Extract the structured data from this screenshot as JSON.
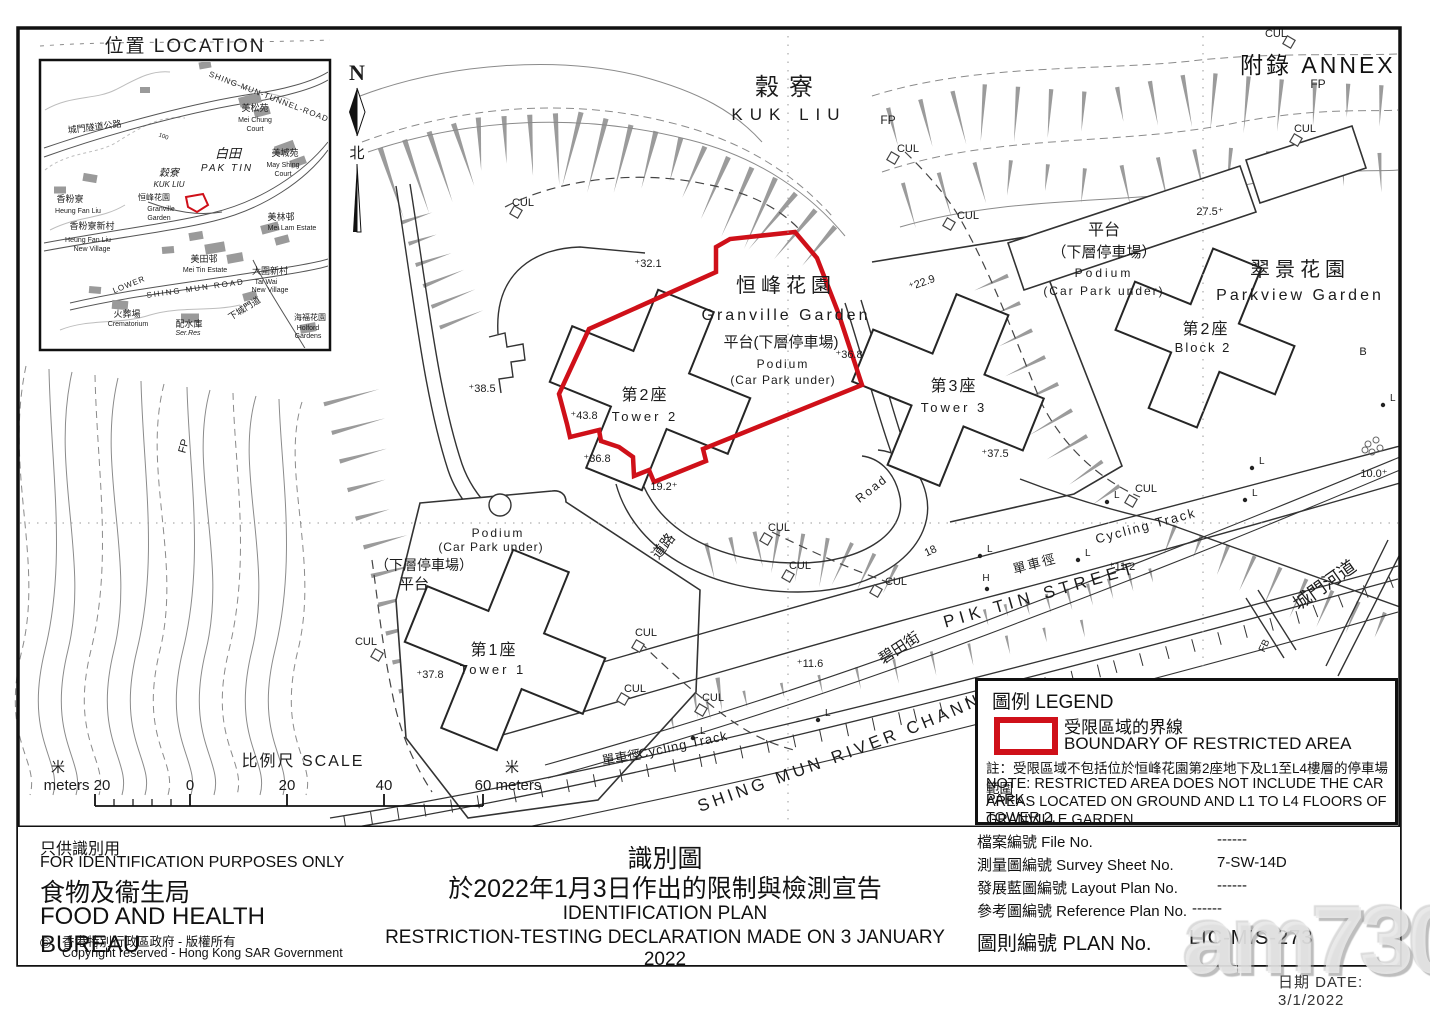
{
  "page": {
    "annex": "附錄 ANNEX",
    "watermark": "am730"
  },
  "colors": {
    "boundary_red": "#cf1019",
    "line_dark": "#2a2a2a",
    "line_gray": "#888888"
  },
  "compass": {
    "n": "N",
    "north": "北"
  },
  "inset": {
    "title": "位置 LOCATION",
    "labels": [
      {
        "t": "SHING-MUN-TUNNEL-ROAD",
        "x": 268,
        "y": 99,
        "s": 8,
        "r": 21,
        "sp": 1
      },
      {
        "t": "城門隧道公路",
        "x": 95,
        "y": 130,
        "s": 9,
        "r": -7
      },
      {
        "t": "100",
        "x": 163,
        "y": 138,
        "s": 6,
        "r": 20
      },
      {
        "t": "美松苑",
        "x": 255,
        "y": 111,
        "s": 9
      },
      {
        "t": "Mei Chung",
        "x": 255,
        "y": 122,
        "s": 7
      },
      {
        "t": "Court",
        "x": 255,
        "y": 131,
        "s": 7
      },
      {
        "t": "白田",
        "x": 228,
        "y": 158,
        "s": 13,
        "i": 1
      },
      {
        "t": "PAK TIN",
        "x": 227,
        "y": 171,
        "s": 10,
        "i": 1,
        "sp": 2
      },
      {
        "t": "美城苑",
        "x": 285,
        "y": 156,
        "s": 9
      },
      {
        "t": "May Shing",
        "x": 283,
        "y": 167,
        "s": 7
      },
      {
        "t": "Court",
        "x": 283,
        "y": 176,
        "s": 7
      },
      {
        "t": "穀寮",
        "x": 169,
        "y": 176,
        "s": 10,
        "i": 1
      },
      {
        "t": "KUK LIU",
        "x": 169,
        "y": 187,
        "s": 8,
        "i": 1
      },
      {
        "t": "恒峰花園",
        "x": 154,
        "y": 200,
        "s": 8
      },
      {
        "t": "Granville",
        "x": 161,
        "y": 211,
        "s": 7
      },
      {
        "t": "Garden",
        "x": 159,
        "y": 220,
        "s": 7
      },
      {
        "t": "香粉寮",
        "x": 70,
        "y": 202,
        "s": 9
      },
      {
        "t": "Heung Fan Liu",
        "x": 78,
        "y": 213,
        "s": 7
      },
      {
        "t": "香粉寮新村",
        "x": 92,
        "y": 229,
        "s": 9
      },
      {
        "t": "Heung Fan Liu",
        "x": 88,
        "y": 242,
        "s": 7
      },
      {
        "t": "New Village",
        "x": 92,
        "y": 251,
        "s": 7
      },
      {
        "t": "美林邨",
        "x": 281,
        "y": 220,
        "s": 9
      },
      {
        "t": "Mei Lam Estate",
        "x": 292,
        "y": 230,
        "s": 7
      },
      {
        "t": "美田邨",
        "x": 204,
        "y": 262,
        "s": 9
      },
      {
        "t": "Mei Tin Estate",
        "x": 205,
        "y": 272,
        "s": 7
      },
      {
        "t": "大圍新村",
        "x": 270,
        "y": 274,
        "s": 9
      },
      {
        "t": "Tai Wai",
        "x": 266,
        "y": 284,
        "s": 7
      },
      {
        "t": "New Village",
        "x": 270,
        "y": 292,
        "s": 7
      },
      {
        "t": "LOWER",
        "x": 130,
        "y": 287,
        "s": 8,
        "r": -22,
        "sp": 1
      },
      {
        "t": "SHING MUN ROAD",
        "x": 196,
        "y": 291,
        "s": 8,
        "r": -8,
        "sp": 2
      },
      {
        "t": "火葬場",
        "x": 127,
        "y": 317,
        "s": 9
      },
      {
        "t": "Crematorium",
        "x": 128,
        "y": 326,
        "s": 7
      },
      {
        "t": "配水庫",
        "x": 189,
        "y": 327,
        "s": 9
      },
      {
        "t": "Ser.Res",
        "x": 188,
        "y": 335,
        "s": 7,
        "i": 1
      },
      {
        "t": "下城門道",
        "x": 246,
        "y": 311,
        "s": 9,
        "r": -32
      },
      {
        "t": "海福花園",
        "x": 310,
        "y": 320,
        "s": 8
      },
      {
        "t": "Holford",
        "x": 308,
        "y": 330,
        "s": 7
      },
      {
        "t": "Gardens",
        "x": 308,
        "y": 338,
        "s": 7
      }
    ]
  },
  "map": {
    "river": "SHING MUN RIVER CHANNEL",
    "lamp": "L",
    "labels": [
      {
        "t": "穀寮",
        "x": 789,
        "y": 95,
        "s": 24,
        "sp": 10
      },
      {
        "t": "KUK LIU",
        "x": 789,
        "y": 120,
        "s": 17,
        "sp": 7
      },
      {
        "t": "FP",
        "x": 888,
        "y": 124,
        "s": 12
      },
      {
        "t": "CUL",
        "x": 908,
        "y": 152,
        "s": 11
      },
      {
        "t": "CUL",
        "x": 523,
        "y": 206,
        "s": 11
      },
      {
        "t": "CUL",
        "x": 968,
        "y": 219,
        "s": 11
      },
      {
        "t": "CUL",
        "x": 1276,
        "y": 37,
        "s": 11
      },
      {
        "t": "FP",
        "x": 1318,
        "y": 88,
        "s": 12
      },
      {
        "t": "CUL",
        "x": 1305,
        "y": 132,
        "s": 11
      },
      {
        "t": "平台",
        "x": 1104,
        "y": 235,
        "s": 16
      },
      {
        "t": "（下層停車場）",
        "x": 1104,
        "y": 257,
        "s": 15
      },
      {
        "t": "Podium",
        "x": 1104,
        "y": 277,
        "s": 12,
        "sp": 3
      },
      {
        "t": "(Car Park under)",
        "x": 1104,
        "y": 295,
        "s": 12,
        "sp": 2
      },
      {
        "t": "27.5⁺",
        "x": 1210,
        "y": 215,
        "s": 11
      },
      {
        "t": "翠景花園",
        "x": 1300,
        "y": 276,
        "s": 20,
        "sp": 5
      },
      {
        "t": "Parkview Garden",
        "x": 1300,
        "y": 300,
        "s": 16,
        "sp": 3
      },
      {
        "t": "第2座",
        "x": 1206,
        "y": 334,
        "s": 16,
        "sp": 2
      },
      {
        "t": "Block 2",
        "x": 1203,
        "y": 352,
        "s": 13,
        "sp": 2
      },
      {
        "t": "⁺22.9",
        "x": 923,
        "y": 286,
        "s": 11,
        "r": -20
      },
      {
        "t": "恒峰花園",
        "x": 786,
        "y": 292,
        "s": 20,
        "sp": 5
      },
      {
        "t": "Granville Garden",
        "x": 786,
        "y": 320,
        "s": 16,
        "sp": 3
      },
      {
        "t": "平台(下層停車場)",
        "x": 781,
        "y": 347,
        "s": 15
      },
      {
        "t": "Podium",
        "x": 783,
        "y": 368,
        "s": 12,
        "sp": 2
      },
      {
        "t": "(Car Park under)",
        "x": 783,
        "y": 384,
        "s": 12,
        "sp": 1
      },
      {
        "t": "⁺36.8",
        "x": 849,
        "y": 358,
        "s": 11
      },
      {
        "t": "⁺32.1",
        "x": 648,
        "y": 267,
        "s": 11
      },
      {
        "t": "⁺38.5",
        "x": 482,
        "y": 392,
        "s": 11
      },
      {
        "t": "第2座",
        "x": 645,
        "y": 400,
        "s": 16,
        "sp": 2
      },
      {
        "t": "Tower 2",
        "x": 645,
        "y": 421,
        "s": 13,
        "sp": 3
      },
      {
        "t": "⁺43.8",
        "x": 584,
        "y": 419,
        "s": 11
      },
      {
        "t": "⁺36.8",
        "x": 597,
        "y": 462,
        "s": 11
      },
      {
        "t": "19.2⁺",
        "x": 664,
        "y": 490,
        "s": 11
      },
      {
        "t": "第3座",
        "x": 954,
        "y": 391,
        "s": 16,
        "sp": 2
      },
      {
        "t": "Tower 3",
        "x": 954,
        "y": 412,
        "s": 13,
        "sp": 3
      },
      {
        "t": "⁺37.5",
        "x": 995,
        "y": 457,
        "s": 11
      },
      {
        "t": "Road",
        "x": 874,
        "y": 492,
        "s": 12,
        "r": -38,
        "sp": 2
      },
      {
        "t": "道路",
        "x": 667,
        "y": 549,
        "s": 14,
        "r": -52
      },
      {
        "t": "CUL",
        "x": 779,
        "y": 531,
        "s": 11
      },
      {
        "t": "CUL",
        "x": 800,
        "y": 569,
        "s": 11
      },
      {
        "t": "CUL",
        "x": 896,
        "y": 585,
        "s": 11
      },
      {
        "t": "18",
        "x": 932,
        "y": 554,
        "s": 11,
        "r": -25
      },
      {
        "t": "CUL",
        "x": 1146,
        "y": 492,
        "s": 11
      },
      {
        "t": "H",
        "x": 986,
        "y": 581,
        "s": 10
      },
      {
        "t": "單車徑",
        "x": 1036,
        "y": 568,
        "s": 13,
        "r": -15,
        "sp": 2
      },
      {
        "t": "Cycling Track",
        "x": 1147,
        "y": 530,
        "s": 13,
        "r": -15,
        "sp": 2
      },
      {
        "t": "PIK TIN STREET",
        "x": 1042,
        "y": 600,
        "s": 17,
        "r": -16,
        "sp": 5
      },
      {
        "t": "⁺11.2",
        "x": 1122,
        "y": 570,
        "s": 11
      },
      {
        "t": "碧田街",
        "x": 902,
        "y": 652,
        "s": 15,
        "r": -33
      },
      {
        "t": "⁺11.6",
        "x": 810,
        "y": 667,
        "s": 11
      },
      {
        "t": "城門河道",
        "x": 1328,
        "y": 590,
        "s": 18,
        "r": -35
      },
      {
        "t": "單車徑",
        "x": 622,
        "y": 762,
        "s": 13,
        "r": -10
      },
      {
        "t": "Cycling Track",
        "x": 684,
        "y": 749,
        "s": 13,
        "r": -12,
        "sp": 1
      },
      {
        "t": "FP",
        "x": 187,
        "y": 447,
        "s": 11,
        "r": -75
      },
      {
        "t": "CUL",
        "x": 366,
        "y": 645,
        "s": 11
      },
      {
        "t": "Podium",
        "x": 498,
        "y": 537,
        "s": 12,
        "sp": 2
      },
      {
        "t": "(Car Park under)",
        "x": 491,
        "y": 551,
        "s": 12,
        "sp": 1
      },
      {
        "t": "（下層停車場）",
        "x": 424,
        "y": 570,
        "s": 14
      },
      {
        "t": "平台",
        "x": 414,
        "y": 589,
        "s": 15
      },
      {
        "t": "第1座",
        "x": 494,
        "y": 655,
        "s": 16,
        "sp": 2
      },
      {
        "t": "Tower 1",
        "x": 493,
        "y": 674,
        "s": 13,
        "sp": 3
      },
      {
        "t": "⁺37.8",
        "x": 430,
        "y": 678,
        "s": 11
      },
      {
        "t": "CUL",
        "x": 646,
        "y": 636,
        "s": 11
      },
      {
        "t": "CUL",
        "x": 635,
        "y": 692,
        "s": 11
      },
      {
        "t": "CUL",
        "x": 713,
        "y": 701,
        "s": 11
      },
      {
        "t": "10.0⁺",
        "x": 1374,
        "y": 477,
        "s": 11
      },
      {
        "t": "B",
        "x": 1363,
        "y": 355,
        "s": 11
      },
      {
        "t": "FB",
        "x": 1267,
        "y": 647,
        "s": 10,
        "r": -65
      }
    ]
  },
  "legend": {
    "title": "圖例 LEGEND",
    "item_zh": "受限區域的界線",
    "item_en": "BOUNDARY OF RESTRICTED AREA",
    "note_line1": "註：受限區域不包括位於恒峰花園第2座地下及L1至L4樓層的停車場範圍",
    "note_line2": "NOTE: RESTRICTED AREA DOES NOT INCLUDE THE CAR PARK",
    "note_line3": "AREAS LOCATED ON GROUND AND L1 TO L4 FLOORS OF TOWER 2,",
    "note_line4": "GRANVILLE GARDEN"
  },
  "scale": {
    "title": "比例尺 SCALE",
    "m_zh_left": "米",
    "m_zh_right": "米",
    "v_m20": "meters 20",
    "v0": "0",
    "v20": "20",
    "v40": "40",
    "v60": "60 meters"
  },
  "footer": {
    "left": {
      "zh1": "只供識別用",
      "en1": "FOR IDENTIFICATION PURPOSES ONLY",
      "zh2": "食物及衞生局",
      "en2": "FOOD AND HEALTH BUREAU",
      "copyright_symbol": "©",
      "copy_zh": "香港特別行政區政府 - 版權所有",
      "copy_en": "Copyright reserved - Hong Kong SAR Government"
    },
    "center": {
      "zh1": "識別圖",
      "zh2": "於2022年1月3日作出的限制與檢測宣告",
      "en1": "IDENTIFICATION PLAN",
      "en2": "RESTRICTION-TESTING DECLARATION MADE ON 3 JANUARY 2022"
    },
    "table": [
      {
        "label": "檔案編號 File No.",
        "value": "------"
      },
      {
        "label": "測量圖編號 Survey Sheet No.",
        "value": "7-SW-14D"
      },
      {
        "label": "發展藍圖編號 Layout Plan No.",
        "value": "------"
      },
      {
        "label": "參考圖編號 Reference Plan No.",
        "value": "------"
      }
    ],
    "plan_label": "圖則編號 PLAN No.",
    "plan_value": "LIC-MIS-273",
    "date": "日期 DATE: 3/1/2022"
  }
}
